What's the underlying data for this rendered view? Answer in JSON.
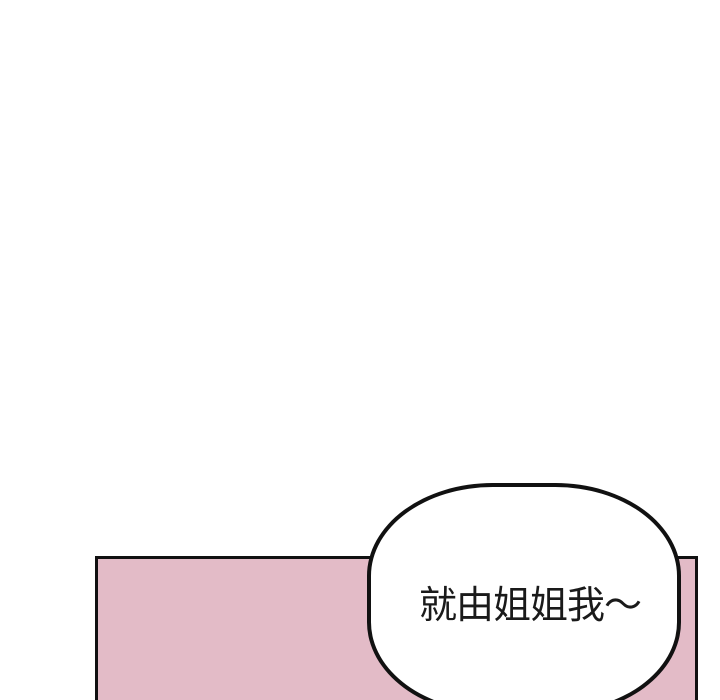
{
  "page": {
    "type": "comic-panel",
    "background": "#ffffff"
  },
  "panel": {
    "fill": "#e3bbc7",
    "border_color": "#111111"
  },
  "speech_bubble": {
    "text": "就由姐姐我～",
    "fill": "#ffffff",
    "border_color": "#111111",
    "text_color": "#1a1a1a"
  },
  "colors": {
    "page_bg": "#ffffff",
    "panel_pink": "#e3bbc7",
    "line_black": "#111111",
    "bubble_white": "#ffffff",
    "text_black": "#1a1a1a"
  }
}
